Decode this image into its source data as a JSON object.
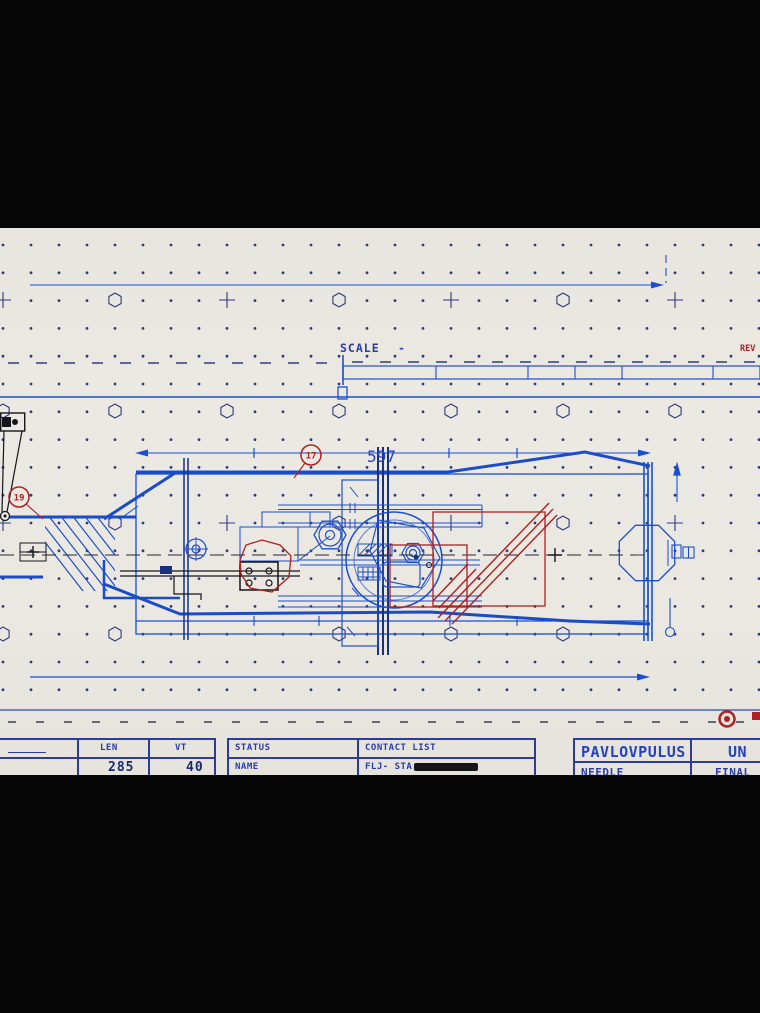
{
  "annotations": {
    "scale_label": "SCALE",
    "scale_suffix": "-",
    "rev_label": "REV",
    "dimension_length": "597",
    "balloon_a": "17",
    "balloon_b": "19"
  },
  "title_block": {
    "dim_table": {
      "len_label": "LEN",
      "vt_label": "VT",
      "len_value": "285",
      "vt_value": "40"
    },
    "status_table": {
      "status_label": "STATUS",
      "name_label": "NAME",
      "contact_list_label": "CONTACT LIST",
      "contact_name_visible": "FLJ-  STA"
    },
    "project_table": {
      "company": "PAVLOVPULUS",
      "code": "UN",
      "item": "NEEDLE",
      "state": "FINAL"
    }
  },
  "colors": {
    "paper": "#eae8e1",
    "blueprint_blue": "#1c4fd0",
    "thick_blue": "#1a4bc8",
    "mast_navy": "#18307f",
    "grid_navy": "#2e3a7e",
    "cad_red": "#b02020",
    "ink_black": "#15151a"
  },
  "grid": {
    "origin_x": 3,
    "origin_y": 245,
    "spacing_x": 28,
    "spacing_y": 27.8,
    "cols": 28,
    "rows": 17
  },
  "grid_symbols": {
    "crosses": [
      [
        3,
        300
      ],
      [
        227,
        300
      ],
      [
        451,
        300
      ],
      [
        675,
        300
      ],
      [
        3,
        523
      ],
      [
        227,
        523
      ],
      [
        451,
        523
      ],
      [
        675,
        523
      ]
    ],
    "hexagons": [
      [
        115,
        300
      ],
      [
        339,
        300
      ],
      [
        563,
        300
      ],
      [
        3,
        411
      ],
      [
        115,
        411
      ],
      [
        227,
        411
      ],
      [
        339,
        411
      ],
      [
        451,
        411
      ],
      [
        563,
        411
      ],
      [
        675,
        411
      ],
      [
        115,
        523
      ],
      [
        339,
        523
      ],
      [
        563,
        523
      ],
      [
        3,
        634
      ],
      [
        115,
        634
      ],
      [
        339,
        634
      ],
      [
        451,
        634
      ],
      [
        563,
        634
      ]
    ]
  }
}
